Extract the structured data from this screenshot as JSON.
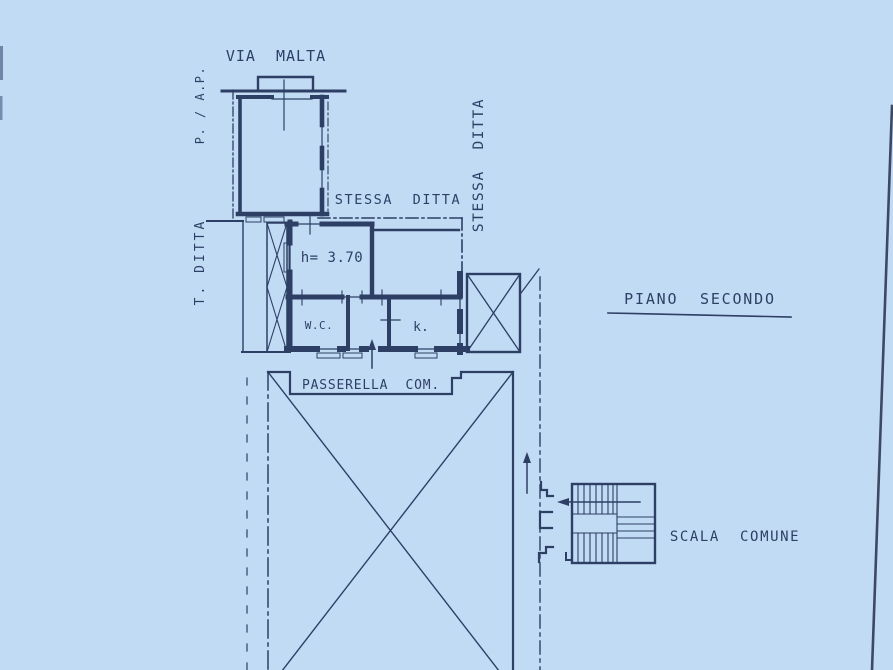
{
  "colors": {
    "paper": "#c2dbf5",
    "ink": "#22345a",
    "edge": "#343e58"
  },
  "plan": {
    "street_label": "VIA  MALTA",
    "floor_title": "PIANO  SECONDO",
    "room_height_note": "h= 3.70",
    "wc_label": "W.C.",
    "kitchen_label": "k.",
    "walkway_label": "PASSERELLA  COM.",
    "common_stairs_label": "SCALA  COMUNE",
    "adjacent_owner_horizontal": "STESSA  DITTA",
    "adjacent_owner_vertical": "STESSA  DITTA",
    "margin_note_top": "P. / A.P.",
    "margin_note_mid": "T. DITTA"
  }
}
